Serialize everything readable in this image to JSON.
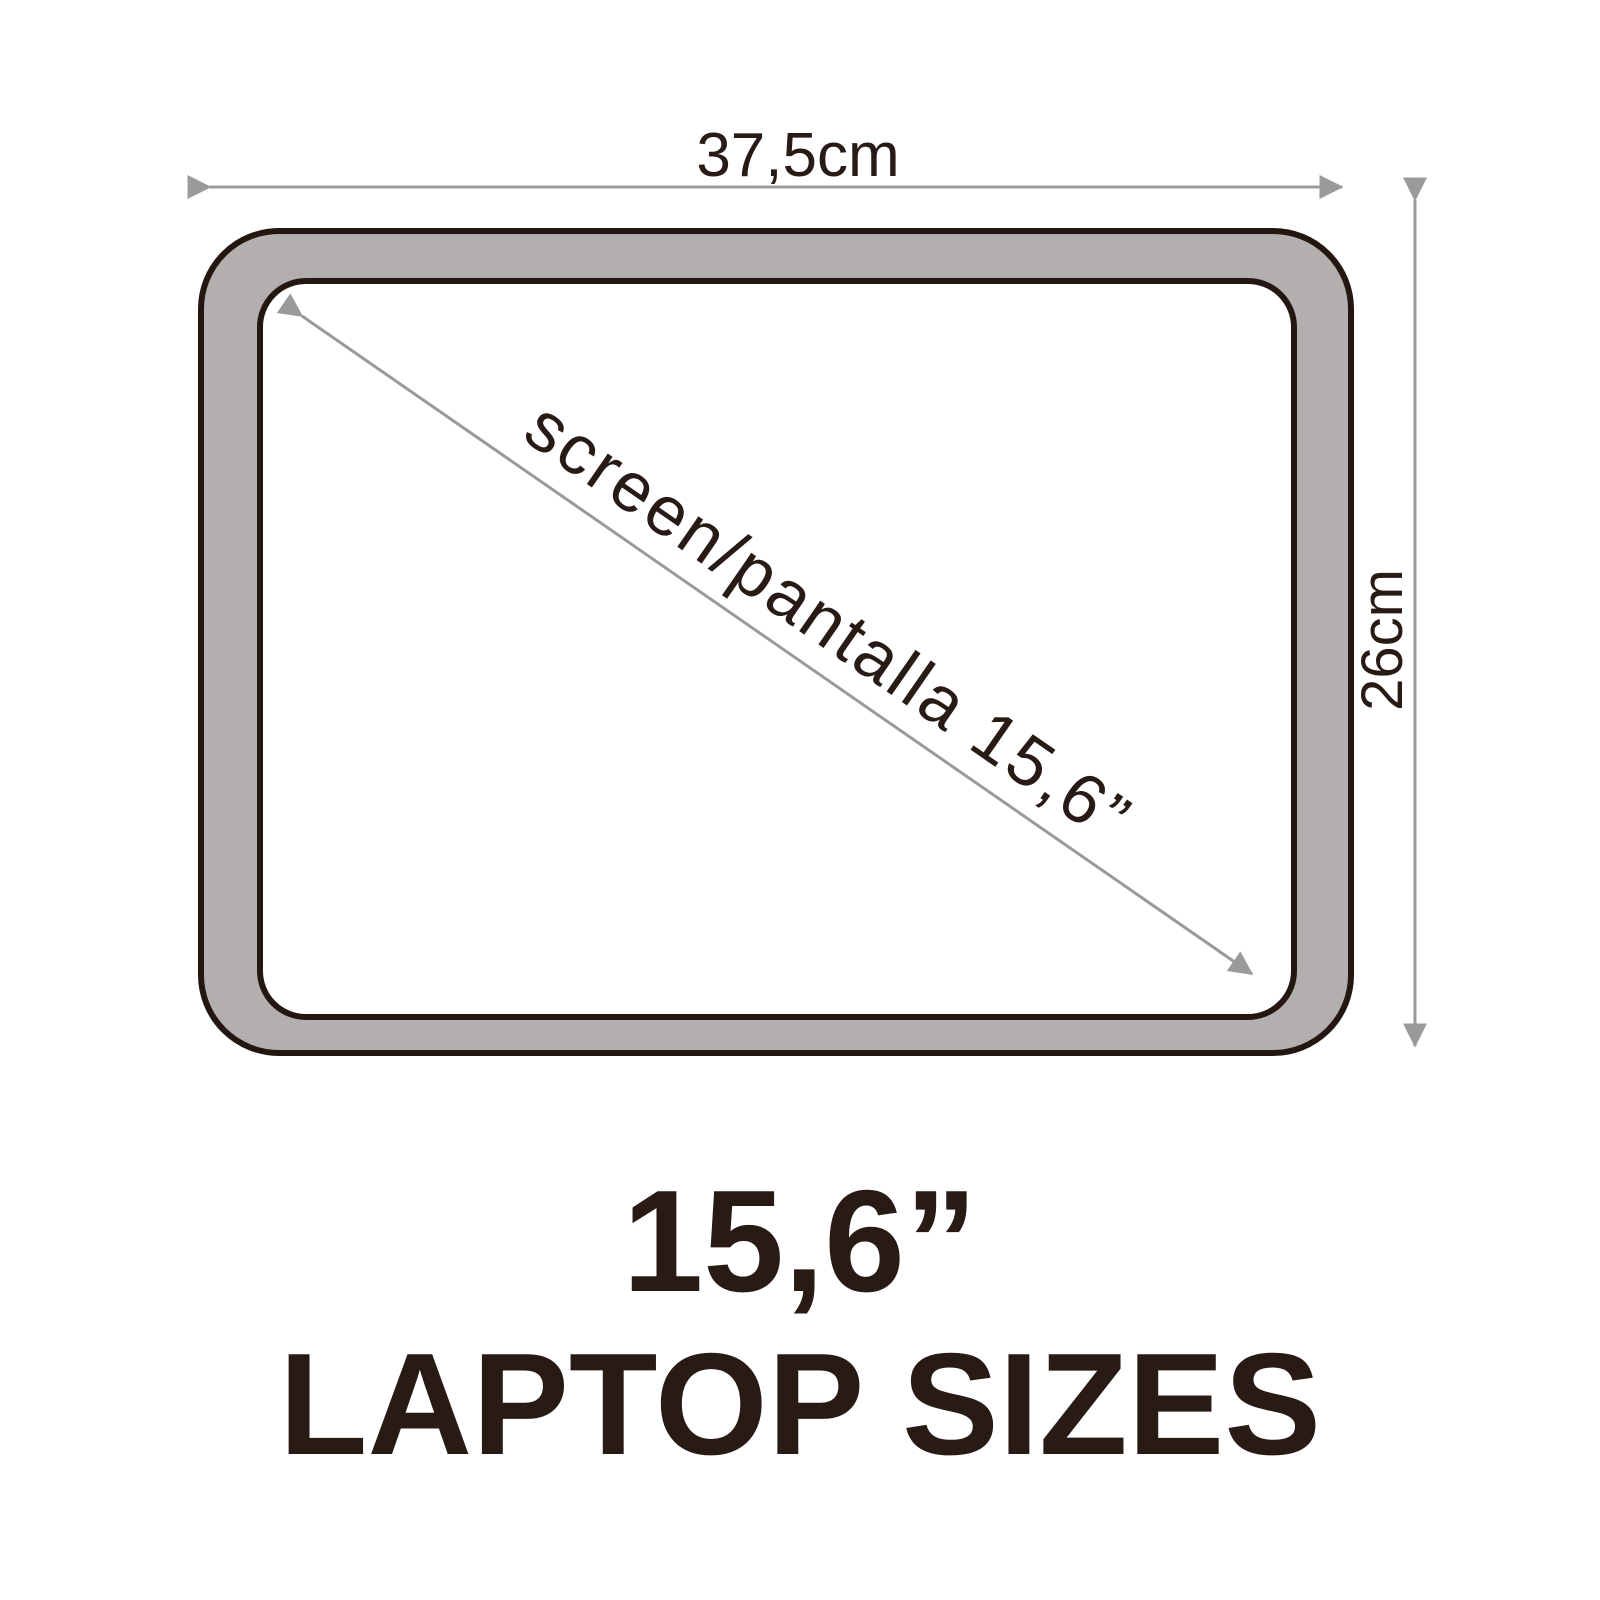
{
  "diagram": {
    "top_dimension_label": "37,5cm",
    "right_dimension_label": "26cm",
    "diagonal_label": "screen/pantalla 15,6”"
  },
  "title": {
    "size_label": "15,6”",
    "caption": "LAPTOP SIZES"
  },
  "colors": {
    "background": "#ffffff",
    "bezel_fill": "#b3afaf",
    "screen_fill": "#ffffff",
    "outline": "#241712",
    "arrow": "#9c9a99",
    "text": "#281b15"
  }
}
